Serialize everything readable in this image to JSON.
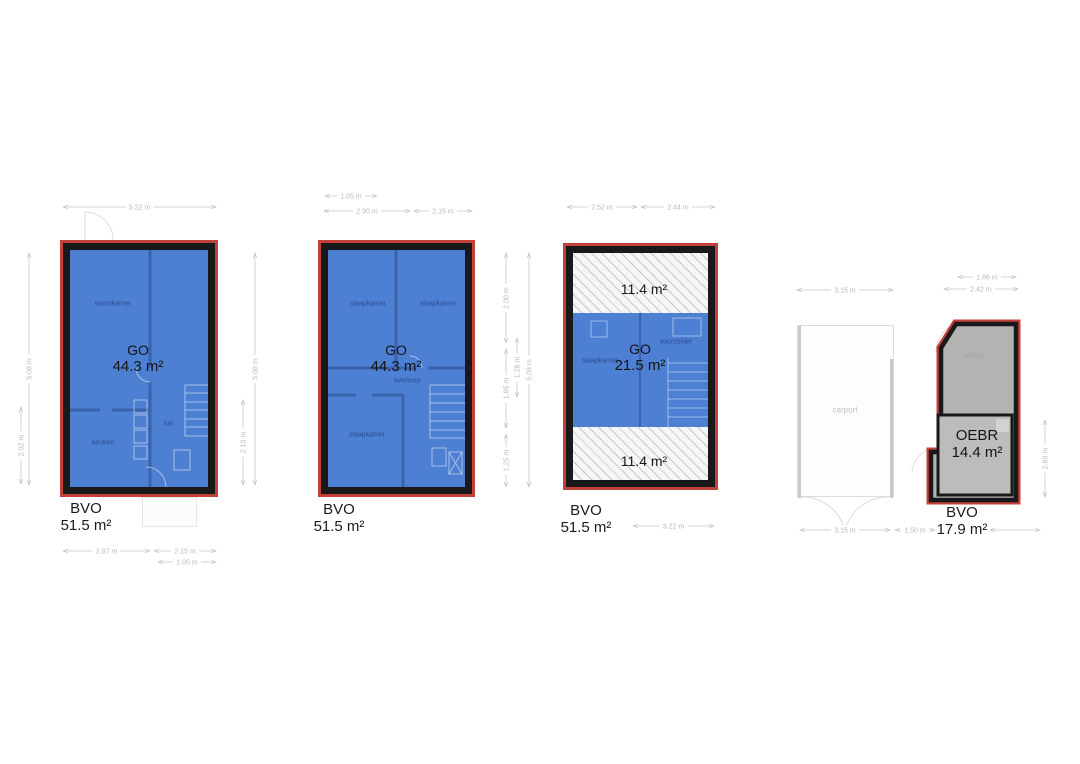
{
  "colors": {
    "plan_fill": "#4d7fd2",
    "wall": "#3a63ab",
    "border_red": "#c4403a",
    "border_black": "#191919",
    "shed_fill": "#b3b3b1",
    "dim": "#c9c9c9"
  },
  "plans": [
    {
      "id": "ground-floor",
      "go_label": "GO",
      "go_value": "44.3 m²",
      "bvo_label": "BVO",
      "bvo_value": "51.5 m²",
      "rooms": {
        "woonkamer": "woonkamer",
        "keuken": "keuken",
        "hal": "hal"
      }
    },
    {
      "id": "first-floor",
      "go_label": "GO",
      "go_value": "44.3 m²",
      "bvo_label": "BVO",
      "bvo_value": "51.5 m²",
      "rooms": {
        "slaapkamer_left": "slaapkamer",
        "slaapkamer_right": "slaapkamer",
        "overloop": "overloop",
        "slaapkamer_bottom": "slaapkamer"
      }
    },
    {
      "id": "second-floor",
      "go_label": "GO",
      "go_value": "21.5 m²",
      "bvo_label": "BVO",
      "bvo_value": "51.5 m²",
      "hatch_top": "11.4 m²",
      "hatch_bottom": "11.4 m²",
      "rooms": {
        "slaapkamer": "slaapkamer",
        "voorzolder": "voorzolder"
      }
    },
    {
      "id": "exterior",
      "carport_label": "carport",
      "schuur_label": "schuur",
      "oebr_label": "OEBR",
      "oebr_value": "14.4 m²",
      "bvo_label": "BVO",
      "bvo_value": "17.9 m²"
    }
  ],
  "dimension_lines": [
    {
      "x1": 63,
      "y1": 207,
      "x2": 216,
      "y2": 207,
      "label": "5.22 m"
    },
    {
      "x1": 325,
      "y1": 196,
      "x2": 377,
      "y2": 196,
      "label": "1.05 m"
    },
    {
      "x1": 324,
      "y1": 211,
      "x2": 410,
      "y2": 211,
      "label": "2.90 m"
    },
    {
      "x1": 414,
      "y1": 211,
      "x2": 472,
      "y2": 211,
      "label": "2.15 m"
    },
    {
      "x1": 567,
      "y1": 207,
      "x2": 637,
      "y2": 207,
      "label": "2.52 m"
    },
    {
      "x1": 641,
      "y1": 207,
      "x2": 715,
      "y2": 207,
      "label": "2.44 m"
    },
    {
      "x1": 797,
      "y1": 290,
      "x2": 893,
      "y2": 290,
      "label": "3.15 m"
    },
    {
      "x1": 958,
      "y1": 277,
      "x2": 1016,
      "y2": 277,
      "label": "1.86 m"
    },
    {
      "x1": 944,
      "y1": 289,
      "x2": 1018,
      "y2": 289,
      "label": "2.42 m"
    },
    {
      "x1": 63,
      "y1": 551,
      "x2": 150,
      "y2": 551,
      "label": "2.87 m"
    },
    {
      "x1": 154,
      "y1": 551,
      "x2": 216,
      "y2": 551,
      "label": "2.15 m"
    },
    {
      "x1": 158,
      "y1": 562,
      "x2": 216,
      "y2": 562,
      "label": "1.05 m"
    },
    {
      "x1": 633,
      "y1": 526,
      "x2": 714,
      "y2": 526,
      "label": "3.22 m"
    },
    {
      "x1": 800,
      "y1": 530,
      "x2": 890,
      "y2": 530,
      "label": "3.15 m"
    },
    {
      "x1": 895,
      "y1": 530,
      "x2": 935,
      "y2": 530,
      "label": "1.50 m"
    },
    {
      "x1": 990,
      "y1": 530,
      "x2": 1040,
      "y2": 530,
      "label": ""
    },
    {
      "x1": 29,
      "y1": 253,
      "x2": 29,
      "y2": 485,
      "label": "5.08 m"
    },
    {
      "x1": 21,
      "y1": 407,
      "x2": 21,
      "y2": 484,
      "label": "2.02 m"
    },
    {
      "x1": 243,
      "y1": 400,
      "x2": 243,
      "y2": 485,
      "label": "2.10 m"
    },
    {
      "x1": 255,
      "y1": 253,
      "x2": 255,
      "y2": 485,
      "label": "5.08 m"
    },
    {
      "x1": 506,
      "y1": 253,
      "x2": 506,
      "y2": 343,
      "label": "2.00 m"
    },
    {
      "x1": 506,
      "y1": 349,
      "x2": 506,
      "y2": 428,
      "label": "1.85 m"
    },
    {
      "x1": 506,
      "y1": 434,
      "x2": 506,
      "y2": 487,
      "label": "1.25 m"
    },
    {
      "x1": 517,
      "y1": 338,
      "x2": 517,
      "y2": 397,
      "label": "1.28 m"
    },
    {
      "x1": 529,
      "y1": 253,
      "x2": 529,
      "y2": 487,
      "label": "5.08 m"
    },
    {
      "x1": 1045,
      "y1": 420,
      "x2": 1045,
      "y2": 497,
      "label": "2.60 m"
    }
  ]
}
